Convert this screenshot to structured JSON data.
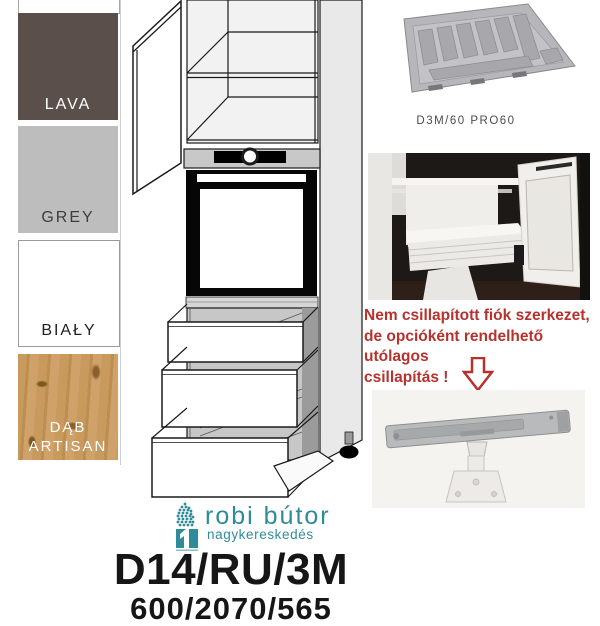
{
  "page": {
    "background": "#ffffff"
  },
  "swatch_panel": {
    "swatches": [
      {
        "label": "LAVA",
        "color": "#5b4f4b",
        "label_color": "#ffffff"
      },
      {
        "label": "GREY",
        "color": "#bdbdbd",
        "label_color": "#3d3d3d"
      },
      {
        "label": "BIAŁY",
        "color": "#ffffff",
        "label_color": "#1f1f1f"
      },
      {
        "label": "DĄB ARTISAN",
        "color": "#c89a5e",
        "label_color": "#ffffff"
      }
    ]
  },
  "accessories": {
    "tray_caption": "D3M/60 PRO60",
    "tray_caption_color": "#4c4c4c"
  },
  "note": {
    "lines": [
      "Nem csillapított fiók szerkezet,",
      "de opcióként rendelhető utólagos",
      "csillapítás !"
    ],
    "color": "#b5322d",
    "arrow_icon": "down-arrow-icon"
  },
  "logo": {
    "name": "robi bútor",
    "tagline": "nagykereskedés",
    "color": "#2e8c99",
    "icon": "tree-icon"
  },
  "product": {
    "code": "D14/RU/3M",
    "dimensions": "600/2070/565"
  }
}
